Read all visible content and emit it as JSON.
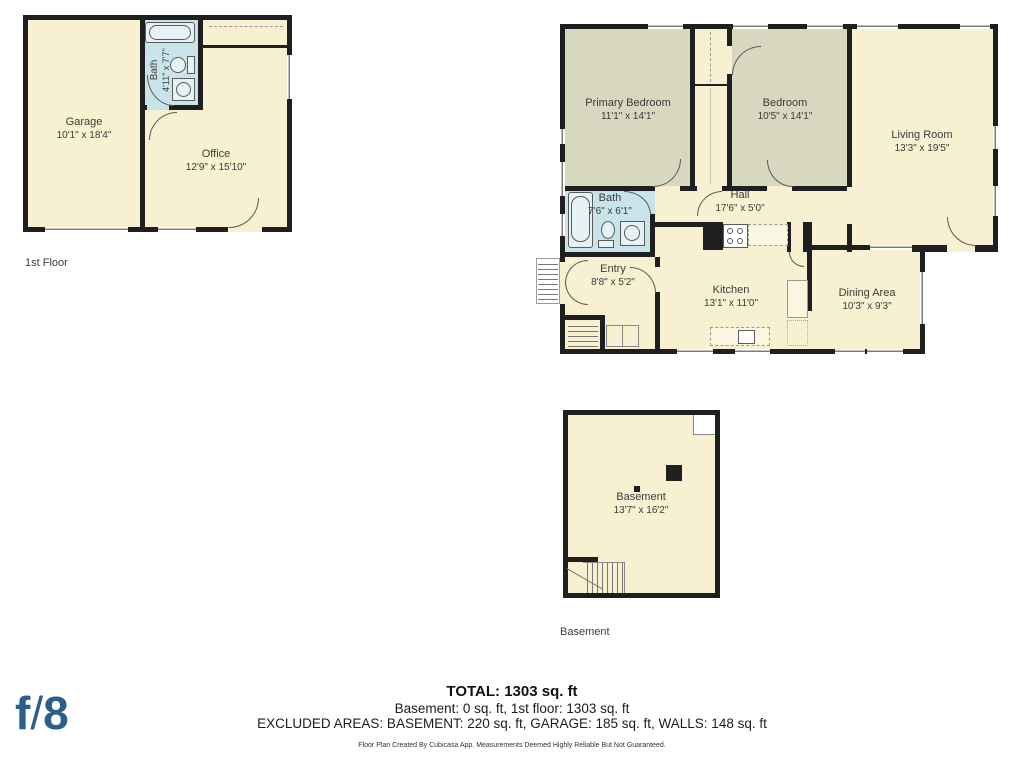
{
  "floors": {
    "first": {
      "caption": "1st Floor",
      "garage": {
        "name": "Garage",
        "dims": "10'1\" x 18'4\""
      },
      "bath": {
        "name": "Bath",
        "dims": "4'11\" x 7'7\""
      },
      "office": {
        "name": "Office",
        "dims": "12'9\" x 15'10\""
      }
    },
    "main": {
      "primary_bedroom": {
        "name": "Primary Bedroom",
        "dims": "11'1\" x 14'1\""
      },
      "bedroom": {
        "name": "Bedroom",
        "dims": "10'5\" x 14'1\""
      },
      "living_room": {
        "name": "Living Room",
        "dims": "13'3\" x 19'5\""
      },
      "bath": {
        "name": "Bath",
        "dims": "7'6\" x 6'1\""
      },
      "hall": {
        "name": "Hall",
        "dims": "17'6\" x 5'0\""
      },
      "entry": {
        "name": "Entry",
        "dims": "8'8\" x 5'2\""
      },
      "kitchen": {
        "name": "Kitchen",
        "dims": "13'1\" x 11'0\""
      },
      "dining": {
        "name": "Dining Area",
        "dims": "10'3\" x 9'3\""
      }
    },
    "basement": {
      "caption": "Basement",
      "basement": {
        "name": "Basement",
        "dims": "13'7\" x 16'2\""
      }
    }
  },
  "summary": {
    "total": "TOTAL: 1303 sq. ft",
    "floors_line": "Basement: 0 sq. ft, 1st floor: 1303 sq. ft",
    "excluded_line": "EXCLUDED AREAS: BASEMENT: 220 sq. ft, GARAGE: 185 sq. ft, WALLS: 148 sq. ft",
    "credit": "Floor Plan Created By Cubicasa App. Measurements Deemed Highly Reliable But Not Guaranteed."
  },
  "logo": {
    "f": "f",
    "slash": "/",
    "eight": "8"
  },
  "colors": {
    "floor": "#f7f0d1",
    "bedroom_floor": "#d8d7bf",
    "bath_floor": "#c8e3e9",
    "wall": "#1f1f1f",
    "logo_blue": "#2b5e89"
  }
}
